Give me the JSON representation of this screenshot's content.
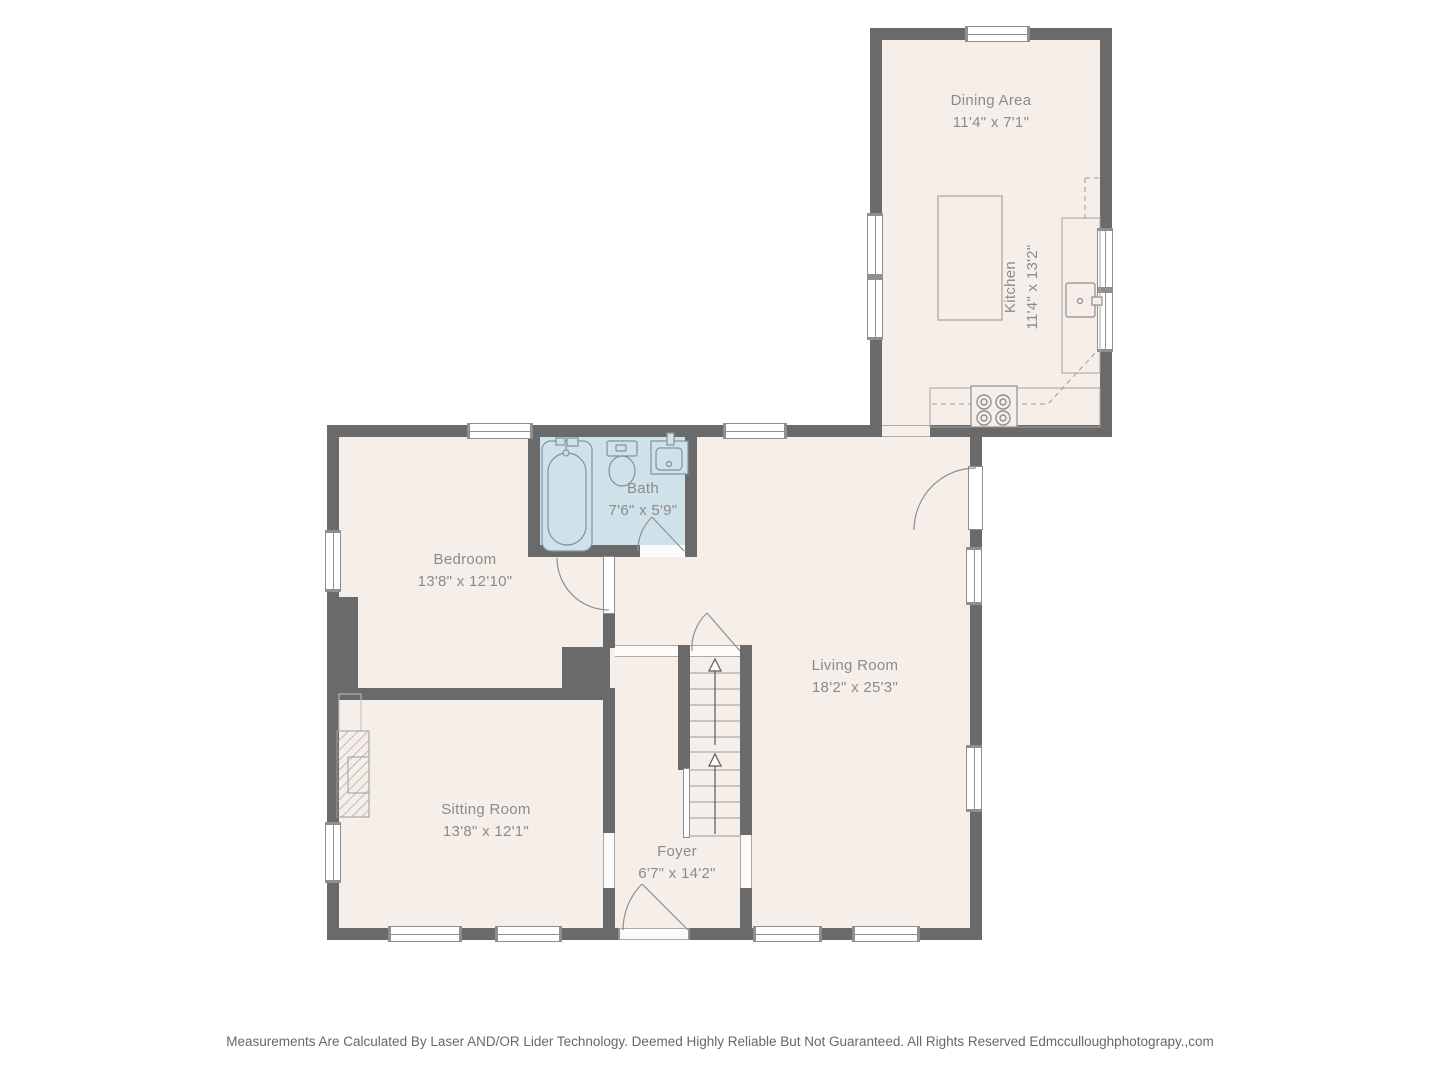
{
  "title": "First floor plan",
  "rooms": [
    {
      "name": "Dining Area",
      "dims": "11'4\" x 7'1\""
    },
    {
      "name": "Kitchen",
      "dims": "11'4\" x 13'2\""
    },
    {
      "name": "Bath",
      "dims": "7'6\" x 5'9\""
    },
    {
      "name": "Bedroom",
      "dims": "13'8\" x 12'10\""
    },
    {
      "name": "Living Room",
      "dims": "18'2\" x 25'3\""
    },
    {
      "name": "Sitting Room",
      "dims": "13'8\" x 12'1\""
    },
    {
      "name": "Foyer",
      "dims": "6'7\" x 14'2\""
    }
  ],
  "footer": {
    "disclaimer": "Measurements Are Calculated By Laser AND/OR Lider Technology. Deemed Highly Reliable But Not Guaranteed. All Rights Reserved Edmcculloughphotograpy.,com"
  },
  "colors": {
    "wall": "#6a6a6a",
    "floor": "#f6eee8",
    "bath_floor": "#cfe1e9",
    "label_text": "#8b8b8b",
    "footer_text": "#65686c"
  }
}
